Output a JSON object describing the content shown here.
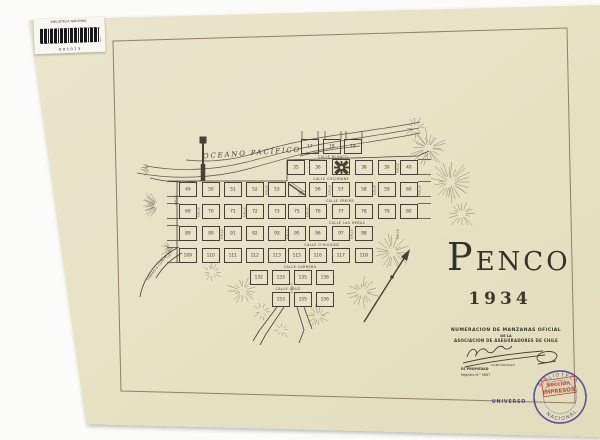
{
  "paper": {
    "color": "#e8e2c6",
    "frame_color": "#8d8166",
    "ink": "#454135"
  },
  "library_label": {
    "title": "BIBLIOTECA NACIONAL",
    "number": "005073"
  },
  "title": {
    "first": "P",
    "rest": "ENCO",
    "year": "1934"
  },
  "legend": {
    "line1": "NUMERACION DE MANZANAS OFICIAL",
    "line2": "DE LA",
    "line3": "ASOCIACION DE ASEGURADORES DE CHILE",
    "signature_caption": "COMISIONADO",
    "property": "ES PROPIEDAD",
    "register": "Registro N.° 5887"
  },
  "printer_mark": "UNIVERSO",
  "stamp": {
    "top": "BIBLIOTECA",
    "bottom": "NACIONAL",
    "star": "★",
    "center1": "Sección",
    "center2": "IMPRESOS",
    "color": "#4b3f8c",
    "accent": "#b23b2c"
  },
  "map": {
    "ocean": "OCEANO PACÍFICO",
    "camino": "CAMINO A CONCEPCION",
    "plaza": {
      "x": 341,
      "y": 167
    },
    "split": {
      "x": 297,
      "y": 189,
      "label": "55"
    },
    "streets_h": [
      {
        "t": "CALLE BLANCO",
        "x": 333,
        "y": 156.5
      },
      {
        "t": "CALLE COCHRANE",
        "x": 331,
        "y": 178.5
      },
      {
        "t": "CALLE FREIRE",
        "x": 340,
        "y": 200.5
      },
      {
        "t": "CALLE LAS HERAS",
        "x": 347,
        "y": 222.5
      },
      {
        "t": "CALLE O'HIGGINS",
        "x": 322,
        "y": 244.5
      },
      {
        "t": "CALLE CARRERA",
        "x": 300,
        "y": 266.5
      },
      {
        "t": "CALLE CRUZ",
        "x": 288,
        "y": 288.5
      }
    ],
    "streets_v": [
      {
        "t": "CALLE",
        "x": 199,
        "y": 212
      },
      {
        "t": "CALLE",
        "x": 222,
        "y": 234
      },
      {
        "t": "CALLE",
        "x": 245,
        "y": 212
      },
      {
        "t": "CALLE",
        "x": 267,
        "y": 190
      },
      {
        "t": "CALLE",
        "x": 288,
        "y": 234
      },
      {
        "t": "CALLE",
        "x": 308,
        "y": 212
      },
      {
        "t": "CALLE",
        "x": 330,
        "y": 190
      },
      {
        "t": "CALLE",
        "x": 352,
        "y": 234
      },
      {
        "t": "CALLE",
        "x": 375,
        "y": 190
      },
      {
        "t": "CALLE",
        "x": 398,
        "y": 168
      },
      {
        "t": "CALLE",
        "x": 398,
        "y": 234
      },
      {
        "t": "CALLE",
        "x": 420,
        "y": 190
      },
      {
        "t": "CALLE",
        "x": 176,
        "y": 200
      },
      {
        "t": "CALLE",
        "x": 292,
        "y": 288
      }
    ],
    "blocks": [
      {
        "n": "17",
        "x": 310,
        "y": 146
      },
      {
        "n": "18",
        "x": 332,
        "y": 146
      },
      {
        "n": "19",
        "x": 353,
        "y": 146
      },
      {
        "n": "35",
        "x": 296,
        "y": 167
      },
      {
        "n": "36",
        "x": 318,
        "y": 167
      },
      {
        "n": "38",
        "x": 364,
        "y": 167
      },
      {
        "n": "39",
        "x": 387,
        "y": 167
      },
      {
        "n": "40",
        "x": 409,
        "y": 167
      },
      {
        "n": "49",
        "x": 188,
        "y": 189
      },
      {
        "n": "50",
        "x": 211,
        "y": 189
      },
      {
        "n": "51",
        "x": 233,
        "y": 189
      },
      {
        "n": "52",
        "x": 255,
        "y": 189
      },
      {
        "n": "53",
        "x": 277,
        "y": 189
      },
      {
        "n": "56",
        "x": 318,
        "y": 189
      },
      {
        "n": "57",
        "x": 341,
        "y": 189
      },
      {
        "n": "58",
        "x": 364,
        "y": 189
      },
      {
        "n": "59",
        "x": 387,
        "y": 189
      },
      {
        "n": "60",
        "x": 409,
        "y": 189
      },
      {
        "n": "69",
        "x": 188,
        "y": 211
      },
      {
        "n": "70",
        "x": 211,
        "y": 211
      },
      {
        "n": "71",
        "x": 233,
        "y": 211
      },
      {
        "n": "72",
        "x": 255,
        "y": 211
      },
      {
        "n": "73",
        "x": 277,
        "y": 211
      },
      {
        "n": "75",
        "x": 297,
        "y": 211
      },
      {
        "n": "76",
        "x": 318,
        "y": 211
      },
      {
        "n": "77",
        "x": 341,
        "y": 211
      },
      {
        "n": "78",
        "x": 364,
        "y": 211
      },
      {
        "n": "79",
        "x": 387,
        "y": 211
      },
      {
        "n": "80",
        "x": 409,
        "y": 211
      },
      {
        "n": "89",
        "x": 188,
        "y": 233
      },
      {
        "n": "90",
        "x": 211,
        "y": 233
      },
      {
        "n": "91",
        "x": 233,
        "y": 233
      },
      {
        "n": "92",
        "x": 255,
        "y": 233
      },
      {
        "n": "93",
        "x": 277,
        "y": 233
      },
      {
        "n": "95",
        "x": 297,
        "y": 233
      },
      {
        "n": "96",
        "x": 318,
        "y": 233
      },
      {
        "n": "97",
        "x": 341,
        "y": 233
      },
      {
        "n": "98",
        "x": 364,
        "y": 233
      },
      {
        "n": "109",
        "x": 188,
        "y": 255
      },
      {
        "n": "110",
        "x": 211,
        "y": 255
      },
      {
        "n": "111",
        "x": 233,
        "y": 255
      },
      {
        "n": "112",
        "x": 255,
        "y": 255
      },
      {
        "n": "113",
        "x": 277,
        "y": 255
      },
      {
        "n": "115",
        "x": 297,
        "y": 255
      },
      {
        "n": "116",
        "x": 318,
        "y": 255
      },
      {
        "n": "117",
        "x": 341,
        "y": 255
      },
      {
        "n": "118",
        "x": 364,
        "y": 255
      },
      {
        "n": "132",
        "x": 259,
        "y": 277
      },
      {
        "n": "133",
        "x": 281,
        "y": 277
      },
      {
        "n": "135",
        "x": 303,
        "y": 277
      },
      {
        "n": "136",
        "x": 325,
        "y": 277
      },
      {
        "n": "153",
        "x": 281,
        "y": 299
      },
      {
        "n": "155",
        "x": 303,
        "y": 299
      },
      {
        "n": "156",
        "x": 325,
        "y": 299
      }
    ]
  }
}
